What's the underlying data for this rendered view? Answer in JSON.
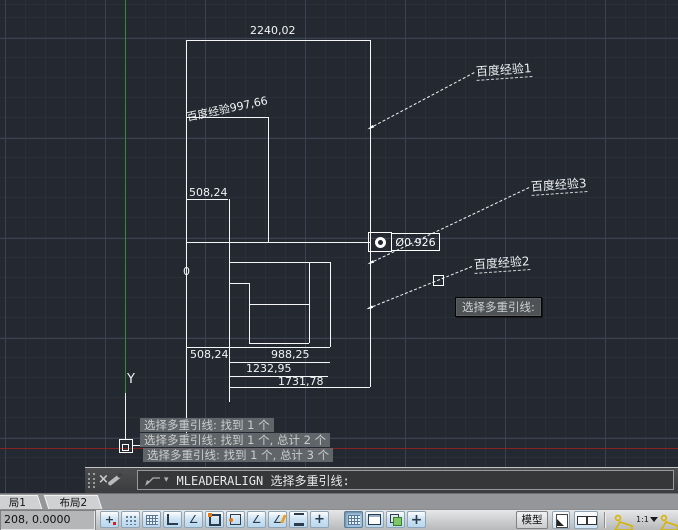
{
  "drawing": {
    "dim_top": "2240,02",
    "dim_diagonal": "百度经验997,66",
    "dim_step": "508,24",
    "dim_zero": "0",
    "dim_chain": [
      "508,24",
      "988,25",
      "1232,95",
      "1731,78"
    ],
    "diameter_label": "Ø0.926",
    "leader_labels": [
      "百度经验1",
      "百度经验3",
      "百度经验2"
    ],
    "ucs_axis_label": "Y",
    "colors": {
      "background": "#232831",
      "line": "#f5f6f7",
      "axis_y_green": "#2f8f2f",
      "axis_x_red": "#8a2222"
    }
  },
  "tooltip": {
    "text": "选择多重引线:"
  },
  "messages": [
    "选择多重引线: 找到 1 个",
    "选择多重引线: 找到 1 个, 总计 2 个",
    "选择多重引线: 找到 1 个, 总计 3 个"
  ],
  "command_bar": {
    "close_glyph": "×",
    "dropdown_glyph": "▾",
    "command_text": "MLEADERALIGN 选择多重引线:"
  },
  "layout_tabs": [
    {
      "label": "局1"
    },
    {
      "label": "布局2"
    }
  ],
  "status_bar": {
    "coordinates": "208, 0.0000",
    "model_button": "模型",
    "scale": "1:1",
    "icon_glyphs": {
      "snap": "+",
      "polar": "∠",
      "angle": "∠",
      "dyn": "∠",
      "qp": "+",
      "bigplus": "+"
    }
  }
}
